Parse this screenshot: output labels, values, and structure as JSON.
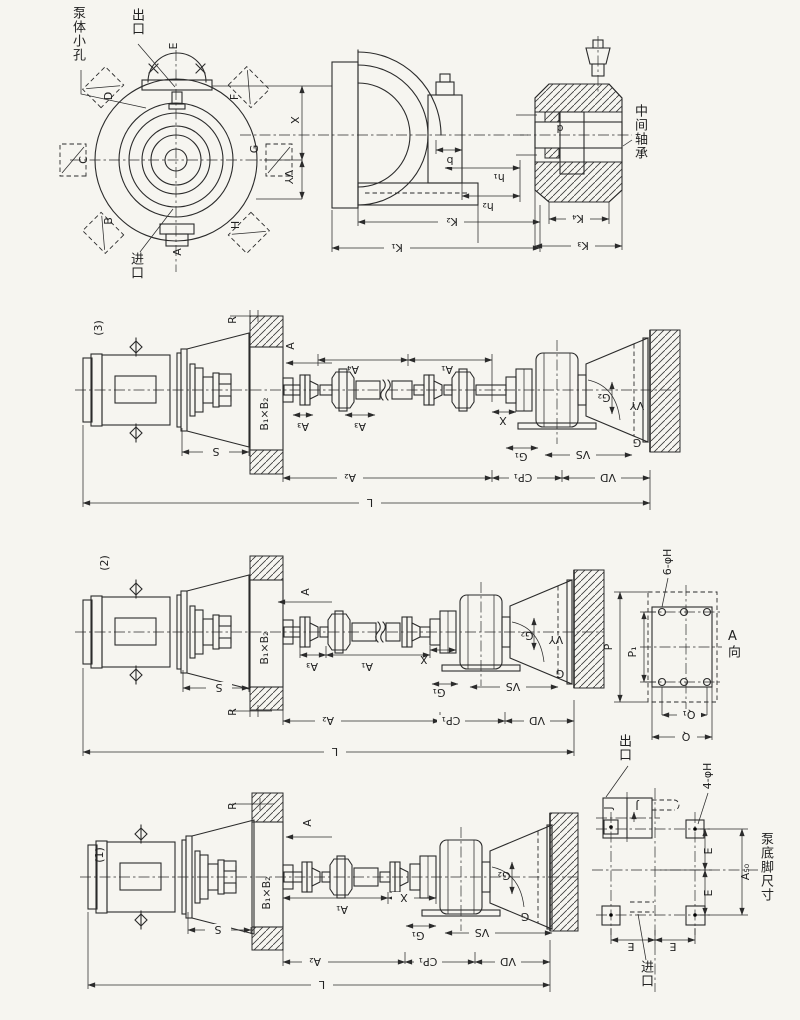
{
  "colors": {
    "ink": "#2b2b2b",
    "paper": "#f6f5f0"
  },
  "casing_front": {
    "callout_small_hole": "泵体小孔",
    "callout_outlet": "出口",
    "callout_inlet": "进口",
    "port_a": "A",
    "port_b": "B",
    "port_c": "C",
    "port_d": "D",
    "port_e": "E",
    "port_f": "F",
    "port_g": "G",
    "port_h": "H",
    "dim_x": "X",
    "dim_vy": "VY"
  },
  "casing_section": {
    "dim_b": "b",
    "dim_h1": "h₁",
    "dim_h2": "h₂",
    "dim_k1": "K₁",
    "dim_k2": "K₂"
  },
  "bearing_section": {
    "callout": "中间轴承",
    "dim_d": "d",
    "dim_k3": "K₃",
    "dim_k4": "K₄"
  },
  "assembly_3": {
    "tag": "(3)",
    "dim_r": "R",
    "view_a": "A",
    "dim_b1b2": "B₁×B₂",
    "dim_s": "S",
    "dim_a4": "A₄",
    "dim_a3_1": "A₃",
    "dim_a3_2": "A₃",
    "dim_a1": "A₁",
    "dim_x": "X",
    "dim_g1": "G₁",
    "dim_g2": "G₂",
    "dim_vy": "VY",
    "dim_g": "G",
    "dim_vs": "VS",
    "dim_vd": "VD",
    "dim_cp1": "CP₁",
    "dim_a2": "A₂",
    "dim_l": "L"
  },
  "assembly_2": {
    "tag": "(2)",
    "dim_r": "R",
    "view_a": "A",
    "dim_b1b2": "B₁×B₂",
    "dim_s": "S",
    "dim_a3": "A₃",
    "dim_a1": "A₁",
    "dim_x": "X",
    "dim_g1": "G₁",
    "dim_g2": "G₂",
    "dim_vy": "VY",
    "dim_g": "G",
    "dim_vs": "VS",
    "dim_vd": "VD",
    "dim_cp1": "CP₁",
    "dim_a2": "A₂",
    "dim_l": "L"
  },
  "assembly_1": {
    "tag": "(1)",
    "dim_r": "R",
    "view_a": "A",
    "dim_b1b2": "B₁×B₂",
    "dim_s": "S",
    "dim_a1": "A₁",
    "dim_x": "X",
    "dim_g1": "G₁",
    "dim_g2": "G₂",
    "dim_g": "G",
    "dim_vs": "VS",
    "dim_vd": "VD",
    "dim_cp1": "CP₁",
    "dim_a2": "A₂",
    "dim_l": "L"
  },
  "flange_view": {
    "dim_holes": "6-φH",
    "dim_p": "P",
    "dim_p1": "P₁",
    "dim_q": "Q",
    "dim_q1": "Q₁",
    "view_dir": "A向"
  },
  "outlet_flange": {
    "callout": "出口",
    "dim_j1": "J",
    "dim_j2": "J"
  },
  "foot_plan": {
    "dim_holes": "4-φH",
    "dim_e1": "E",
    "dim_e2": "E",
    "dim_e3": "E",
    "dim_e4": "E",
    "dim_a50": "A₅₀",
    "caption": "泵底脚尺寸",
    "callout_inlet": "进口"
  }
}
